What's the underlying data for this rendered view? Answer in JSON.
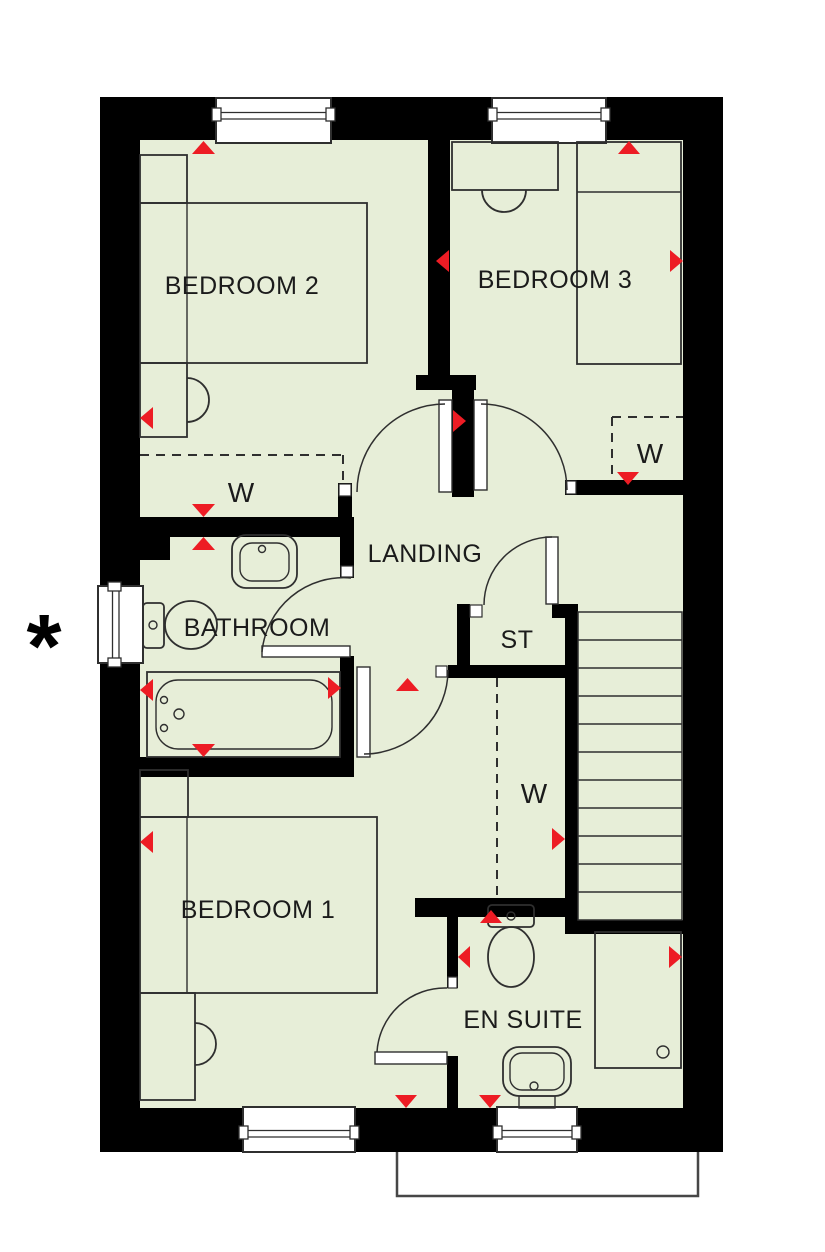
{
  "colors": {
    "background": "#ffffff",
    "floor": "#e7eed8",
    "wall": "#000000",
    "line": "#2f2f2f",
    "marker_red": "#ed1c24",
    "outline_gray": "#474747"
  },
  "rooms": {
    "bedroom2": {
      "label": "BEDROOM 2"
    },
    "bedroom3": {
      "label": "BEDROOM 3"
    },
    "bedroom1": {
      "label": "BEDROOM 1"
    },
    "landing": {
      "label": "LANDING"
    },
    "bathroom": {
      "label": "BATHROOM"
    },
    "store": {
      "label": "ST"
    },
    "ensuite": {
      "label": "EN SUITE"
    }
  },
  "wardrobes": {
    "bedroom2": "W",
    "bedroom3": "W",
    "bedroom1": "W"
  },
  "annotations": {
    "asterisk": "*"
  }
}
